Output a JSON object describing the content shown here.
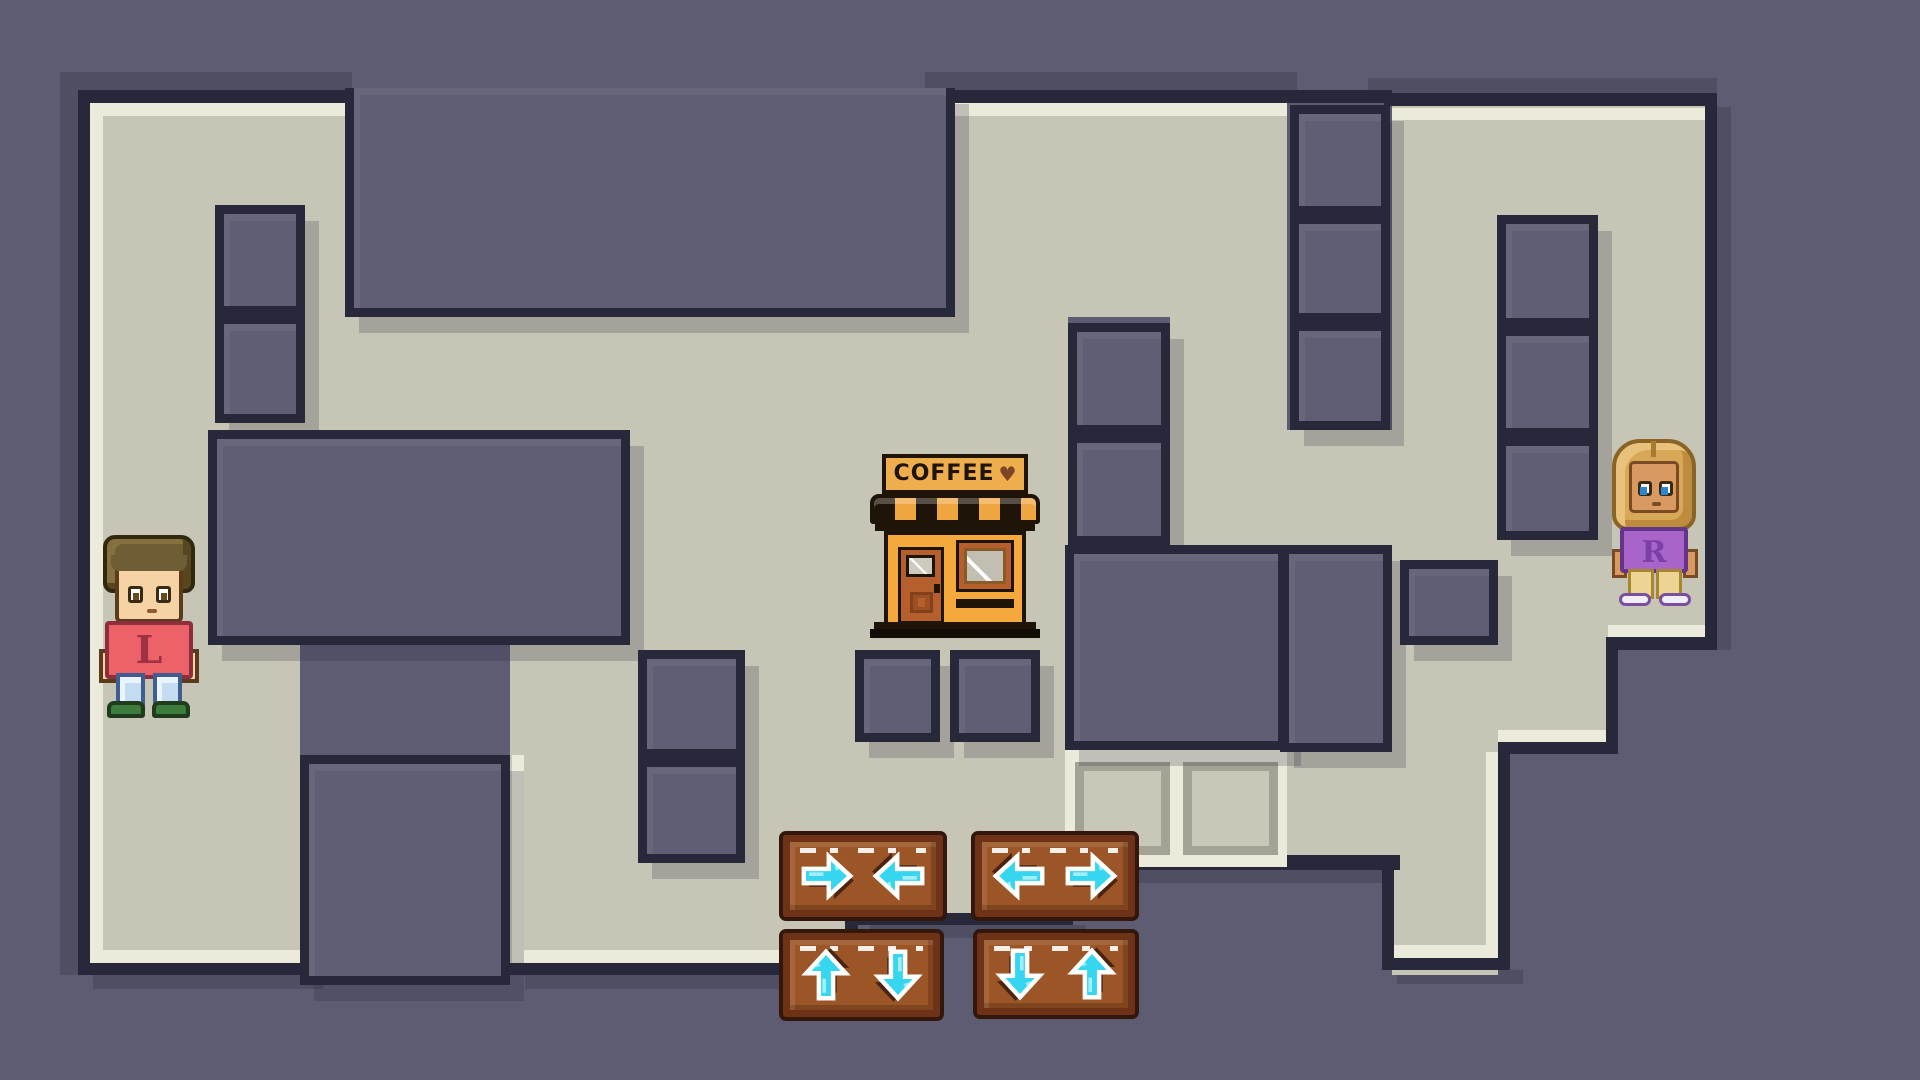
{
  "scene": {
    "title": "two-player maze puzzle",
    "colors": {
      "outside": "#5d5c72",
      "wall": "#5f5e74",
      "navy": "#272839",
      "floor": "#c7c5b6",
      "cream": "#eceadb",
      "oshadow": "#4f4e62",
      "arrow_cyan": "#37d6f0",
      "arrow_shadow": "#4a2410",
      "wood": "#9c5526"
    }
  },
  "maze": {
    "floors": [
      [
        88,
        103,
        257,
        327
      ],
      [
        88,
        430,
        120,
        215
      ],
      [
        88,
        645,
        212,
        330
      ],
      [
        345,
        317,
        610,
        113
      ],
      [
        630,
        430,
        438,
        220
      ],
      [
        955,
        103,
        332,
        214
      ],
      [
        955,
        317,
        113,
        113
      ],
      [
        1170,
        317,
        117,
        228
      ],
      [
        510,
        645,
        345,
        330
      ],
      [
        855,
        645,
        210,
        280
      ],
      [
        1287,
        430,
        105,
        115
      ],
      [
        1287,
        752,
        211,
        115
      ],
      [
        1392,
        637,
        106,
        338
      ],
      [
        1392,
        103,
        313,
        534
      ],
      [
        1498,
        637,
        110,
        105
      ]
    ],
    "creams": [
      [
        90,
        103,
        255,
        13
      ],
      [
        955,
        103,
        332,
        13
      ],
      [
        1392,
        108,
        313,
        12
      ],
      [
        90,
        103,
        13,
        860
      ],
      [
        90,
        950,
        222,
        13
      ],
      [
        512,
        950,
        345,
        13
      ],
      [
        512,
        755,
        12,
        200
      ],
      [
        1392,
        945,
        106,
        13
      ],
      [
        1486,
        752,
        12,
        200
      ],
      [
        1498,
        730,
        110,
        12
      ],
      [
        1608,
        625,
        97,
        12
      ]
    ],
    "navies": [
      [
        78,
        90,
        274,
        13
      ],
      [
        943,
        90,
        449,
        13
      ],
      [
        1384,
        93,
        333,
        13
      ],
      [
        78,
        90,
        12,
        885
      ],
      [
        78,
        963,
        232,
        12
      ],
      [
        502,
        963,
        360,
        12
      ],
      [
        845,
        917,
        13,
        58
      ],
      [
        845,
        913,
        228,
        12
      ],
      [
        1065,
        855,
        335,
        15
      ],
      [
        1382,
        867,
        12,
        103
      ],
      [
        1382,
        958,
        128,
        12
      ],
      [
        1498,
        742,
        12,
        228
      ],
      [
        1498,
        742,
        120,
        12
      ],
      [
        1606,
        645,
        12,
        107
      ],
      [
        1606,
        637,
        111,
        13
      ],
      [
        1705,
        95,
        12,
        555
      ]
    ],
    "outer_shadows": [
      [
        60,
        72,
        18,
        903
      ],
      [
        60,
        72,
        292,
        18
      ],
      [
        925,
        72,
        372,
        18
      ],
      [
        1368,
        78,
        349,
        17
      ],
      [
        1717,
        107,
        14,
        543
      ],
      [
        93,
        975,
        230,
        14
      ],
      [
        525,
        975,
        350,
        14
      ],
      [
        1397,
        970,
        126,
        14
      ],
      [
        870,
        925,
        216,
        13
      ],
      [
        1080,
        870,
        330,
        13
      ]
    ],
    "walls": [
      [
        345,
        88,
        610,
        229,
        "nt"
      ],
      [
        215,
        205,
        90,
        110
      ],
      [
        215,
        315,
        90,
        108
      ],
      [
        208,
        430,
        422,
        215
      ],
      [
        300,
        755,
        210,
        230
      ],
      [
        638,
        650,
        107,
        108
      ],
      [
        638,
        758,
        107,
        105
      ],
      [
        855,
        650,
        85,
        92
      ],
      [
        950,
        650,
        90,
        92
      ],
      [
        1068,
        323,
        102,
        111
      ],
      [
        1068,
        434,
        102,
        111
      ],
      [
        1065,
        545,
        222,
        205
      ],
      [
        1290,
        105,
        100,
        110
      ],
      [
        1290,
        215,
        100,
        107
      ],
      [
        1290,
        322,
        100,
        108
      ],
      [
        1280,
        545,
        112,
        207
      ],
      [
        1497,
        215,
        101,
        112
      ],
      [
        1497,
        327,
        101,
        110
      ],
      [
        1497,
        437,
        101,
        103
      ],
      [
        1400,
        560,
        98,
        85
      ]
    ],
    "goal": {
      "x": 1065,
      "y": 750,
      "w": 222,
      "h": 117,
      "tiles": [
        [
          10,
          12,
          95,
          93
        ],
        [
          118,
          12,
          95,
          93
        ]
      ]
    }
  },
  "shop": {
    "sign_text": "COFFEE",
    "heart": "♥"
  },
  "characters": {
    "left": {
      "letter": "L",
      "letter_color": "#9e3240",
      "description": "boy, red shirt, blue jeans, green shoes"
    },
    "right": {
      "letter": "R",
      "letter_color": "#7b3fa8",
      "description": "girl, purple shirt, tan pants, white shoes"
    }
  },
  "controls": {
    "buttons": [
      {
        "name": "converge-horizontal-button",
        "x": 783,
        "y": 835,
        "w": 160,
        "h": 82,
        "arrows": [
          "right",
          "left"
        ]
      },
      {
        "name": "diverge-horizontal-button",
        "x": 975,
        "y": 835,
        "w": 160,
        "h": 82,
        "arrows": [
          "left",
          "right"
        ]
      },
      {
        "name": "up-down-button",
        "x": 783,
        "y": 933,
        "w": 157,
        "h": 84,
        "arrows": [
          "up",
          "down"
        ]
      },
      {
        "name": "down-up-button",
        "x": 977,
        "y": 933,
        "w": 158,
        "h": 82,
        "arrows": [
          "down",
          "up"
        ]
      }
    ]
  }
}
